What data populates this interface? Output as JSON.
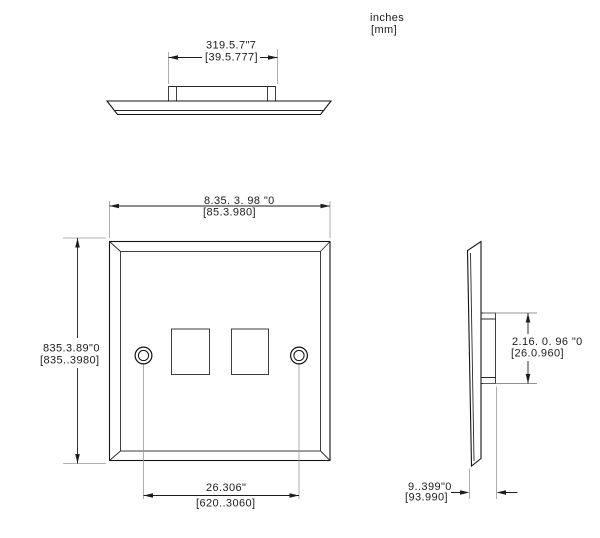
{
  "units_note": {
    "units": "inches",
    "units_alt": "[mm]"
  },
  "dimensions": {
    "top_boss_width": {
      "inches": "319.5.7\"7",
      "mm": "[39.5.777]"
    },
    "plate_width": {
      "inches": "8.35. 3. 98 \"0",
      "mm": "[85.3.980]"
    },
    "plate_height": {
      "inches": "835.3.89\"0",
      "mm": "[835..3980]"
    },
    "screw_spacing": {
      "inches": "26.306\"",
      "mm": "[620..3060]"
    },
    "boss_height": {
      "inches": "2.16. 0. 96 \"0",
      "mm": "[26.0.960]"
    },
    "plate_depth": {
      "inches": "9..399\"0",
      "mm": "[93.990]"
    }
  },
  "colors": {
    "line": "#141414",
    "dimension": "#1c1c1c",
    "extension_line": "#9a9a9a",
    "background": "#ffffff"
  }
}
